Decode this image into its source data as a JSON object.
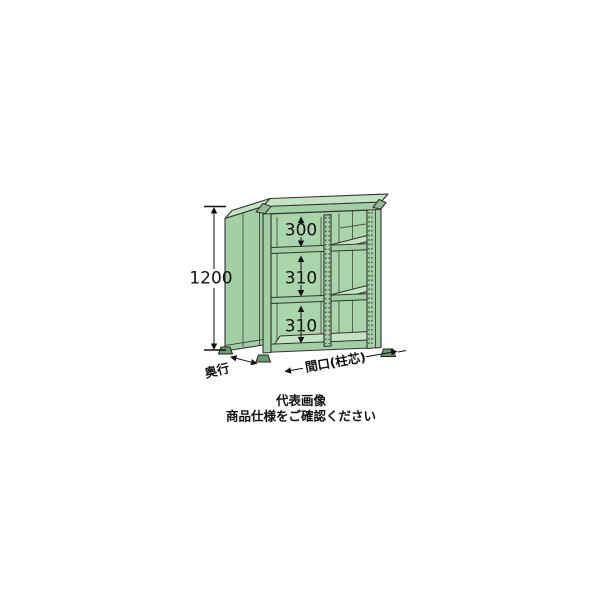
{
  "illustration": {
    "dimensions": {
      "height": "1200",
      "gaps": [
        "300",
        "310",
        "310"
      ],
      "depth": "奥行",
      "width": "間口(柱芯)"
    },
    "caption": {
      "line1": "代表画像",
      "line2": "商品仕様をご確認ください"
    },
    "colors": {
      "background": "#ffffff",
      "body": "#a3cfa4",
      "panel": "#aad5ab",
      "surface": "#c3e3c3",
      "cap": "#8fbd92",
      "feet": "#6b9c70",
      "outline": "#333333",
      "annotation": "#111111"
    }
  }
}
